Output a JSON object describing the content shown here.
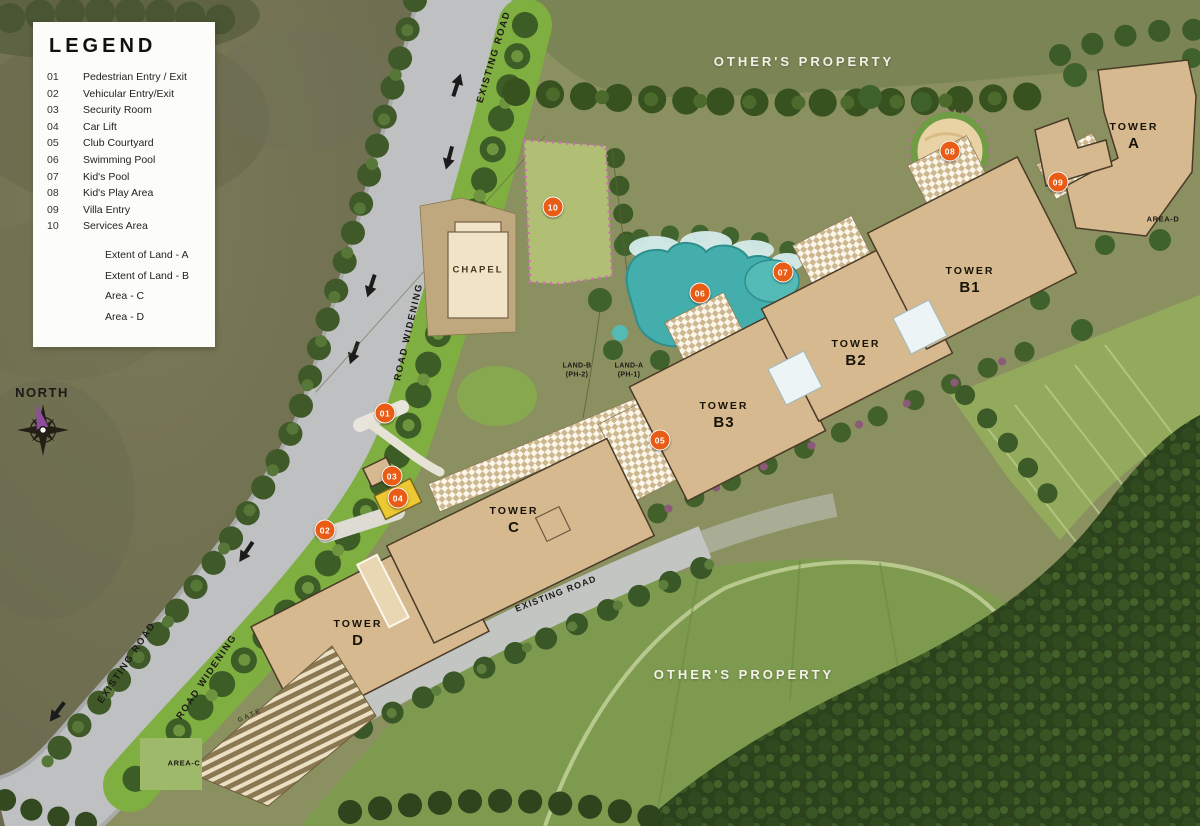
{
  "legend": {
    "title": "LEGEND",
    "items": [
      {
        "num": "01",
        "label": "Pedestrian Entry / Exit"
      },
      {
        "num": "02",
        "label": "Vehicular Entry/Exit"
      },
      {
        "num": "03",
        "label": "Security Room"
      },
      {
        "num": "04",
        "label": "Car Lift"
      },
      {
        "num": "05",
        "label": "Club Courtyard"
      },
      {
        "num": "06",
        "label": "Swimming Pool"
      },
      {
        "num": "07",
        "label": "Kid's Pool"
      },
      {
        "num": "08",
        "label": "Kid's Play Area"
      },
      {
        "num": "09",
        "label": "Villa Entry"
      },
      {
        "num": "10",
        "label": "Services Area"
      }
    ],
    "extents": [
      "Extent of Land - A",
      "Extent of Land - B",
      "Area - C",
      "Area - D"
    ]
  },
  "map": {
    "markers": [
      {
        "n": "01",
        "x": 385,
        "y": 413
      },
      {
        "n": "02",
        "x": 325,
        "y": 530
      },
      {
        "n": "03",
        "x": 392,
        "y": 476
      },
      {
        "n": "04",
        "x": 398,
        "y": 498
      },
      {
        "n": "05",
        "x": 660,
        "y": 440
      },
      {
        "n": "06",
        "x": 700,
        "y": 293
      },
      {
        "n": "07",
        "x": 783,
        "y": 272
      },
      {
        "n": "08",
        "x": 950,
        "y": 151
      },
      {
        "n": "09",
        "x": 1058,
        "y": 182
      },
      {
        "n": "10",
        "x": 553,
        "y": 207
      }
    ],
    "labels": [
      {
        "id": "existing-road-top",
        "cls": "road",
        "x": 494,
        "y": 57,
        "rot": -73,
        "lines": [
          "EXISTING ROAD"
        ]
      },
      {
        "id": "others-property-top",
        "cls": "property",
        "x": 804,
        "y": 62,
        "rot": 0,
        "lines": [
          "OTHER'S PROPERTY"
        ]
      },
      {
        "id": "tower-a",
        "cls": "tower",
        "x": 1134,
        "y": 137,
        "rot": 0,
        "lines": [
          "TOWER",
          "A"
        ]
      },
      {
        "id": "area-d",
        "cls": "area",
        "x": 1163,
        "y": 219,
        "rot": 0,
        "lines": [
          "AREA-D"
        ]
      },
      {
        "id": "tower-b1",
        "cls": "tower",
        "x": 970,
        "y": 281,
        "rot": 0,
        "lines": [
          "TOWER",
          "B1"
        ]
      },
      {
        "id": "tower-b2",
        "cls": "tower",
        "x": 856,
        "y": 354,
        "rot": 0,
        "lines": [
          "TOWER",
          "B2"
        ]
      },
      {
        "id": "tower-b3",
        "cls": "tower",
        "x": 724,
        "y": 416,
        "rot": 0,
        "lines": [
          "TOWER",
          "B3"
        ]
      },
      {
        "id": "tower-c",
        "cls": "tower",
        "x": 514,
        "y": 521,
        "rot": 0,
        "lines": [
          "TOWER",
          "C"
        ]
      },
      {
        "id": "tower-d",
        "cls": "tower",
        "x": 358,
        "y": 634,
        "rot": 0,
        "lines": [
          "TOWER",
          "D"
        ]
      },
      {
        "id": "chapel",
        "cls": "chapel",
        "x": 478,
        "y": 270,
        "rot": 0,
        "lines": [
          "CHAPEL"
        ]
      },
      {
        "id": "land-b",
        "cls": "land",
        "x": 577,
        "y": 371,
        "rot": 0,
        "lines": [
          "LAND-B",
          "(PH-2)"
        ]
      },
      {
        "id": "land-a",
        "cls": "land",
        "x": 629,
        "y": 371,
        "rot": 0,
        "lines": [
          "LAND-A",
          "(PH-1)"
        ]
      },
      {
        "id": "road-widening-mid",
        "cls": "road",
        "x": 409,
        "y": 332,
        "rot": -77,
        "lines": [
          "ROAD WIDENING"
        ]
      },
      {
        "id": "existing-road-mid",
        "cls": "road-sm",
        "x": 556,
        "y": 594,
        "rot": -21,
        "lines": [
          "EXISTING ROAD"
        ]
      },
      {
        "id": "existing-road-left",
        "cls": "road",
        "x": 127,
        "y": 663,
        "rot": -56,
        "lines": [
          "EXISTING ROAD"
        ]
      },
      {
        "id": "road-widening-left",
        "cls": "road",
        "x": 207,
        "y": 677,
        "rot": -56,
        "lines": [
          "ROAD WIDENING"
        ]
      },
      {
        "id": "others-property-bottom",
        "cls": "property",
        "x": 744,
        "y": 675,
        "rot": 0,
        "lines": [
          "OTHER'S PROPERTY"
        ]
      },
      {
        "id": "area-c",
        "cls": "area",
        "x": 184,
        "y": 763,
        "rot": 0,
        "lines": [
          "AREA-C"
        ]
      },
      {
        "id": "gate",
        "cls": "gate",
        "x": 250,
        "y": 716,
        "rot": -24,
        "lines": [
          "GATE"
        ]
      },
      {
        "id": "north",
        "cls": "north",
        "x": 42,
        "y": 393,
        "rot": 0,
        "lines": [
          "NORTH"
        ]
      }
    ]
  },
  "colors": {
    "marker": "#e85c15",
    "building": "#d6b98e",
    "outline": "#4a3b28",
    "pool": "#43aeab",
    "road": "#bec0c1",
    "verge": "#7fae41",
    "sand": "#e9d3a4",
    "lift": "#ecc832",
    "legendBg": "#fcfcf9",
    "propertyText": "#f3f1e8",
    "labelText": "#1c1a16"
  }
}
